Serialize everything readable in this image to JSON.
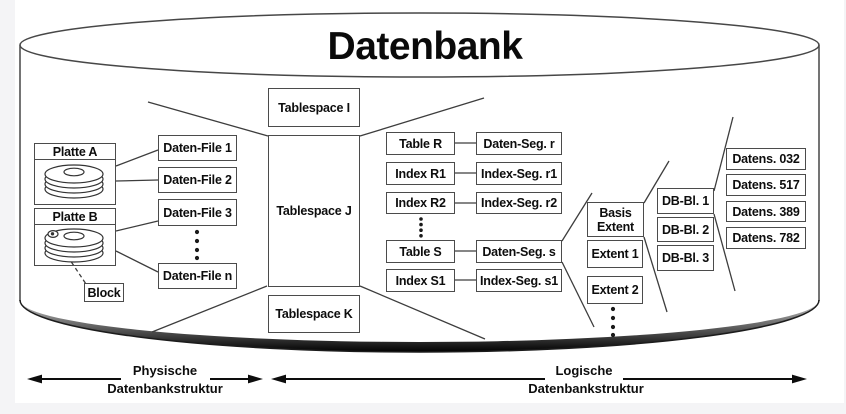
{
  "title": "Datenbank",
  "physical": {
    "disks": [
      {
        "label": "Platte A"
      },
      {
        "label": "Platte B"
      }
    ],
    "block_label": "Block",
    "files": [
      "Daten-File 1",
      "Daten-File 2",
      "Daten-File 3",
      "Daten-File n"
    ]
  },
  "tablespaces": [
    "Tablespace I",
    "Tablespace J",
    "Tablespace K"
  ],
  "tables": [
    {
      "object": "Table R",
      "segment": "Daten-Seg. r"
    },
    {
      "object": "Index R1",
      "segment": "Index-Seg. r1"
    },
    {
      "object": "Index R2",
      "segment": "Index-Seg. r2"
    },
    {
      "object": "Table S",
      "segment": "Daten-Seg. s"
    },
    {
      "object": "Index S1",
      "segment": "Index-Seg. s1"
    }
  ],
  "extents": [
    "Basis Extent",
    "Extent 1",
    "Extent 2"
  ],
  "db_blocks": [
    "DB-Bl. 1",
    "DB-Bl. 2",
    "DB-Bl. 3"
  ],
  "records": [
    "Datens. 032",
    "Datens. 517",
    "Datens. 389",
    "Datens. 782"
  ],
  "legend": {
    "physical": {
      "line1": "Physische",
      "line2": "Datenbankstruktur"
    },
    "logical": {
      "line1": "Logische",
      "line2": "Datenbankstruktur"
    }
  },
  "colors": {
    "line": "#3d3d3d",
    "border": "#4b4b4b",
    "band_dark": "#000000"
  }
}
